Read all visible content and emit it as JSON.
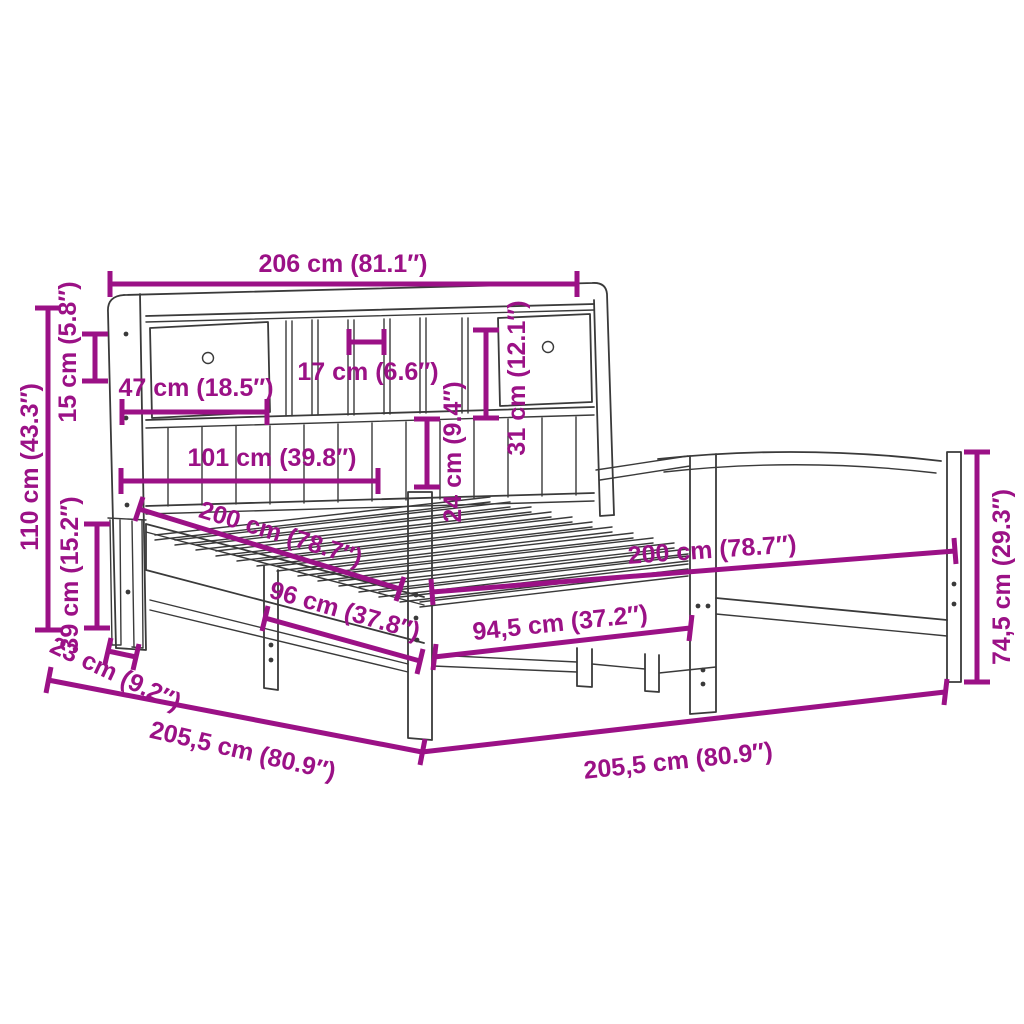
{
  "diagram": {
    "subject": "bed-frame-with-bookcase-headboard-dimension-diagram",
    "colors": {
      "dimension": "#9b1186",
      "outline": "#3a3a3a",
      "background": "#ffffff"
    },
    "dimensions": {
      "headboard_width": "206 cm (81.1″)",
      "headboard_height": "110 cm (43.3″)",
      "top_section_height": "15 cm (5.8″)",
      "clearance_under_bed": "39 cm (15.2″)",
      "drawer_width": "47 cm (18.5″)",
      "compartment_width": "17 cm (6.6″)",
      "right_compartment_height": "31 cm (12.1″)",
      "lower_shelf_height": "24 cm (9.4″)",
      "shelf_width": "101 cm (39.8″)",
      "mattress_length": "200 cm (78.7″)",
      "mattress_width": "200 cm (78.7″)",
      "side_support_span": "96 cm (37.8″)",
      "footboard_inner_width": "94,5 cm (37.2″)",
      "footboard_height": "74,5 cm (29.3″)",
      "headboard_depth": "23 cm (9.2″)",
      "frame_length_side": "205,5 cm (80.9″)",
      "frame_length_front": "205,5 cm (80.9″)"
    }
  }
}
